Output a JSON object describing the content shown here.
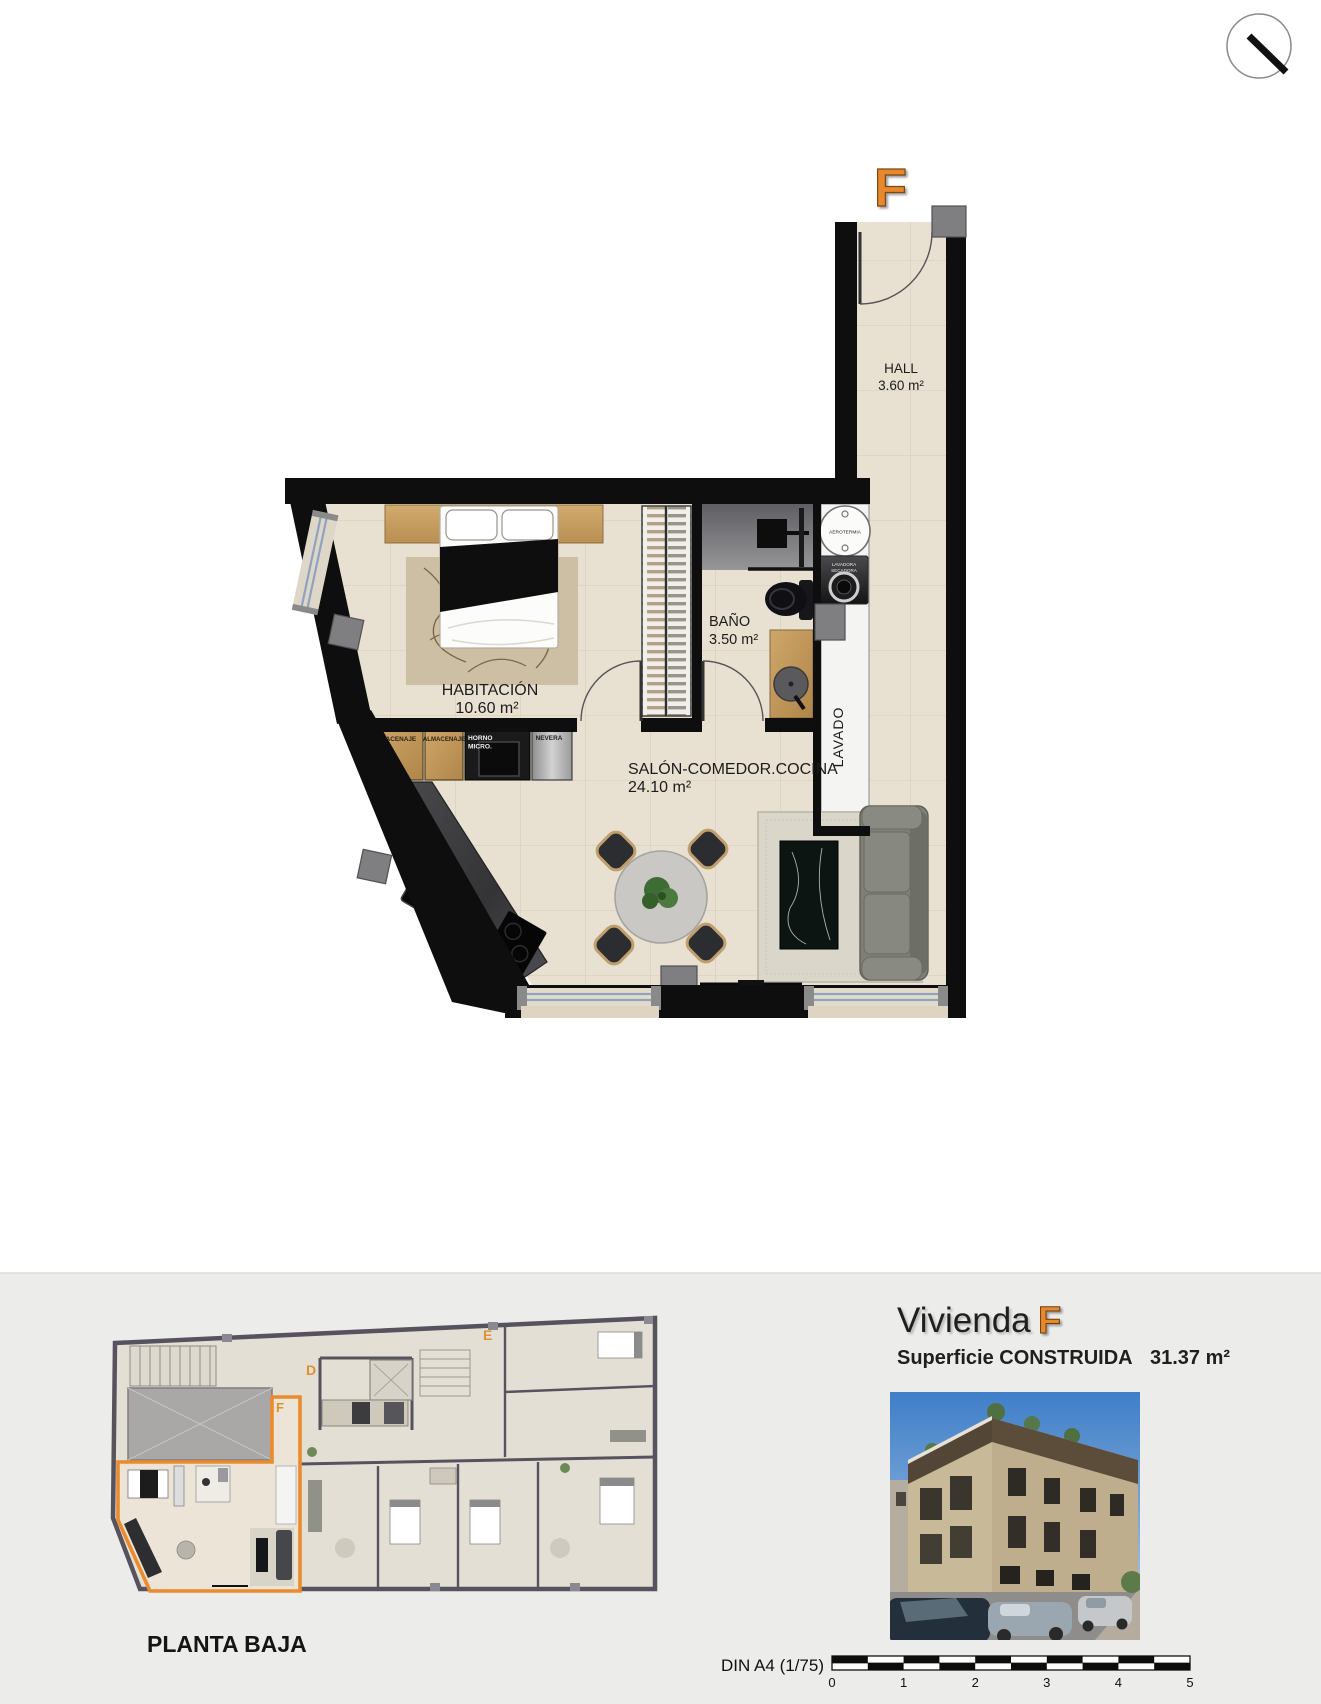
{
  "plan": {
    "unit_letter": "F",
    "rooms": [
      {
        "name": "HALL",
        "area": "3.60 m²"
      },
      {
        "name": "HABITACIÓN",
        "area": "10.60 m²"
      },
      {
        "name": "BAÑO",
        "area": "3.50 m²"
      },
      {
        "name": "SALÓN-COMEDOR.COCINA",
        "area": "24.10 m²"
      }
    ],
    "labels": {
      "lavado": "LAVADO",
      "aerotermia": "AEROTERMIA",
      "lavadora": "LAVADORA",
      "secadora": "SECADORA",
      "almacenaje_1": "ALMACENAJE",
      "almacenaje_2": "ALMACENAJE",
      "horno": "HORNO",
      "micro": "MICRO.",
      "nevera": "NEVERA"
    }
  },
  "overview": {
    "title": "PLANTA BAJA",
    "unit_d": "D",
    "unit_e": "E",
    "unit_f": "F"
  },
  "summary": {
    "title": "Vivienda",
    "unit": "F",
    "surface_label": "Superficie CONSTRUIDA",
    "surface_value": "31.37 m²"
  },
  "scalebar": {
    "label": "DIN A4 (1/75)",
    "ticks": [
      "0",
      "1",
      "2",
      "3",
      "4",
      "5"
    ]
  },
  "colors": {
    "accent_orange": "#E8872B",
    "wall_black": "#0E0E0E",
    "floor_beige": "#E8E0D1",
    "panel_gray": "#ECECEA"
  }
}
